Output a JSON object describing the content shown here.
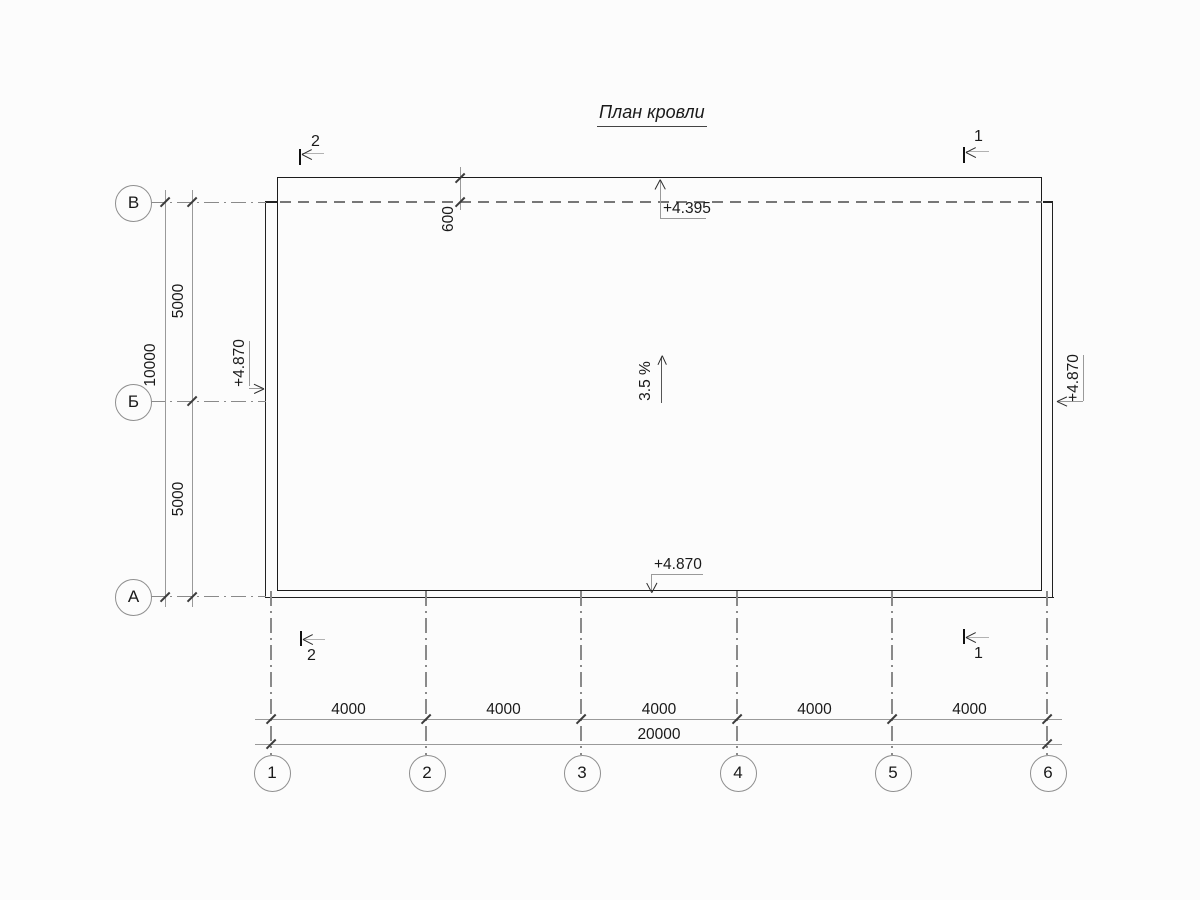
{
  "title": "План кровли",
  "axes": {
    "rows": [
      {
        "label": "В"
      },
      {
        "label": "Б"
      },
      {
        "label": "А"
      }
    ],
    "cols": [
      {
        "label": "1"
      },
      {
        "label": "2"
      },
      {
        "label": "3"
      },
      {
        "label": "4"
      },
      {
        "label": "5"
      },
      {
        "label": "6"
      }
    ]
  },
  "dimensions": {
    "bottom_segments": [
      "4000",
      "4000",
      "4000",
      "4000",
      "4000"
    ],
    "bottom_total": "20000",
    "left_segments": [
      "5000",
      "5000"
    ],
    "left_total": "10000",
    "eave_overhang": "600"
  },
  "elevations": {
    "top_eave": "+4.395",
    "bottom_edge": "+4.870",
    "left_edge": "+4.870",
    "right_edge": "+4.870"
  },
  "slope_label": "3.5 %",
  "section_marks": {
    "top_left": "2",
    "top_right": "1",
    "bottom_left": "2",
    "bottom_right": "1"
  },
  "colors": {
    "outline": "#1c1c1c",
    "dimension_line": "#9a9a9a",
    "axis_line": "#8a8a8a",
    "text": "#1a1a1a",
    "background": "#fcfcfc"
  }
}
